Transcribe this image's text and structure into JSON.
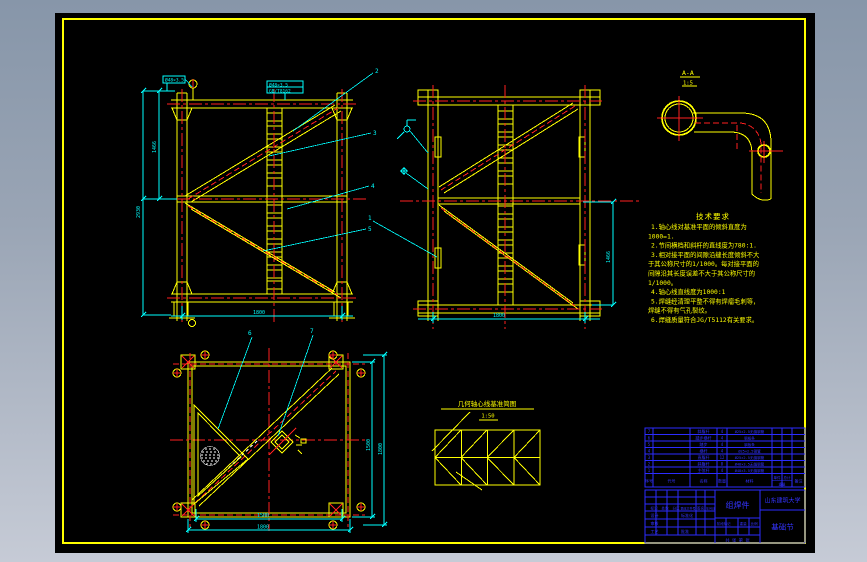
{
  "colors": {
    "background_top": "#8796a9",
    "background_bottom": "#c6cbd6",
    "sheet": "#000000",
    "line_yellow": "#ffff00",
    "line_red": "#ff2020",
    "line_cyan": "#00ffff",
    "line_blue": "#2c2cff",
    "line_white": "#ffffff"
  },
  "pipe_detail": {
    "title": "A-A",
    "scale": "1:5"
  },
  "truss_front": {
    "top_label": "Ø48×3.5",
    "top_box_line1": "Ø48×3.5",
    "top_box_line2": "GB/T8162",
    "dim_left_total": "2930",
    "dim_left_half": "1466",
    "dim_bottom": "1800",
    "callouts": [
      "2",
      "3",
      "4",
      "5"
    ]
  },
  "truss_side": {
    "dim_right": "1466",
    "dim_bottom": "1800",
    "callout": "1"
  },
  "plan": {
    "callout_left": "6",
    "callout_right": "7",
    "dim_right_inner": "1500",
    "dim_right_outer": "1800",
    "dim_bottom_inner": "1500",
    "dim_bottom_outer": "1800"
  },
  "schematic": {
    "title": "几何轴心线基准简图",
    "scale": "1:50"
  },
  "notes": {
    "title": "技术要求",
    "lines": [
      "1.轴心线对基准平面的倾斜直度为",
      "1000=1.",
      "2.节间横档和斜杆的直线度为780:1.",
      "3.相对接平面的间隙沿缝长度倾斜不大",
      "于其公称尺寸的1/1000。每对接平面的",
      "间隙沿其长度误差不大于其公称尺寸的",
      "1/1000。",
      "4.轴心线直线度为1000:1",
      "5.焊缝经清理平整不得有焊瘤毛刺等，",
      "焊缝不得有气孔裂纹。",
      "6.焊缝质量符合JG/T5112有关要求。"
    ]
  },
  "bom": {
    "headers": {
      "no": "序号",
      "code": "代号",
      "name": "名称",
      "qty": "数量",
      "material": "材料",
      "single": "单件",
      "total": "总计",
      "weight": "重量",
      "remark": "备注"
    },
    "rows": [
      {
        "no": "7",
        "name": "斜腹杆",
        "qty": "4",
        "material": "Ø25×2.5无缝钢管"
      },
      {
        "no": "6",
        "name": "踏步横杆",
        "qty": "4",
        "material": "钢板条"
      },
      {
        "no": "5",
        "name": "踏步",
        "qty": "4",
        "material": "钢板条"
      },
      {
        "no": "4",
        "name": "横杆",
        "qty": "4",
        "material": "Ø25×2.5钢管"
      },
      {
        "no": "3",
        "name": "直腹杆",
        "qty": "12",
        "material": "Ø25×2.5无缝钢管"
      },
      {
        "no": "2",
        "name": "斜腹杆",
        "qty": "8",
        "material": "Ø48×3.5无缝钢管"
      },
      {
        "no": "1",
        "name": "主弦杆",
        "qty": "4",
        "material": "Ø48×3.5无缝钢管"
      }
    ]
  },
  "titleblock": {
    "assembly": "组焊件",
    "university": "山东建筑大学",
    "drawing_name": "基础节",
    "row_mark": [
      "标记",
      "处数",
      "分区",
      "更改文件号",
      "签名",
      "年月日"
    ],
    "design": "设计",
    "standard": "标准化",
    "check": "审核",
    "craft": "工艺",
    "approve": "批准",
    "stage": "阶段标记",
    "weight": "重量",
    "scale": "比例",
    "sheets": "共 张 第 张"
  }
}
